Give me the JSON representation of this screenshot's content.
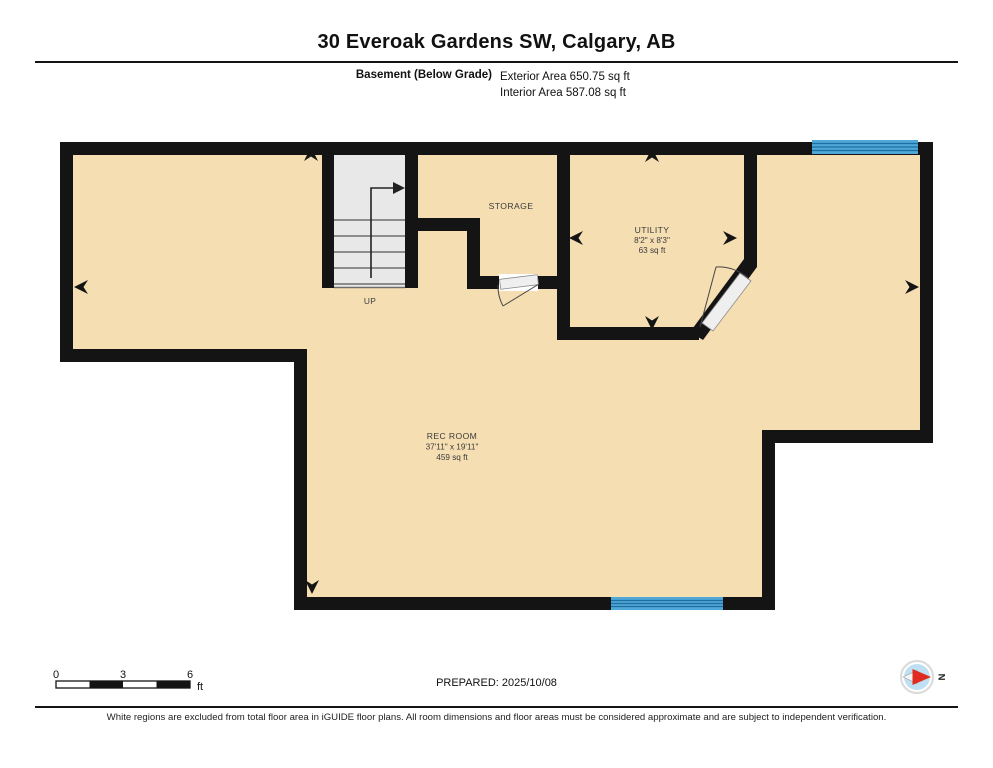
{
  "header": {
    "title": "30 Everoak Gardens SW, Calgary, AB",
    "floor_label": "Basement (Below Grade)",
    "exterior_area": "Exterior Area 650.75 sq ft",
    "interior_area": "Interior Area 587.08 sq ft"
  },
  "rooms": {
    "storage": {
      "name": "STORAGE"
    },
    "utility": {
      "name": "UTILITY",
      "dimensions": "8'2\" x 8'3\"",
      "area": "63 sq ft"
    },
    "rec_room": {
      "name": "REC ROOM",
      "dimensions": "37'11\" x 19'11\"",
      "area": "459 sq ft"
    },
    "stairs": {
      "label": "UP"
    }
  },
  "footer": {
    "scale": {
      "tick0": "0",
      "tick3": "3",
      "tick6": "6",
      "unit": "ft"
    },
    "prepared": "PREPARED: 2025/10/08",
    "compass_label": "N",
    "disclaimer": "White regions are excluded from total floor area in iGUIDE floor plans. All room dimensions and floor areas must be considered approximate and are subject to independent verification."
  },
  "colors": {
    "floor": "#F6DEB3",
    "wall": "#141414",
    "window_blue": "#4FA8D8",
    "window_stripe": "#1E6E9F",
    "stairs_gray": "#E8E8E8",
    "compass_disc": "#BFE0F2",
    "compass_red": "#E02B20"
  }
}
